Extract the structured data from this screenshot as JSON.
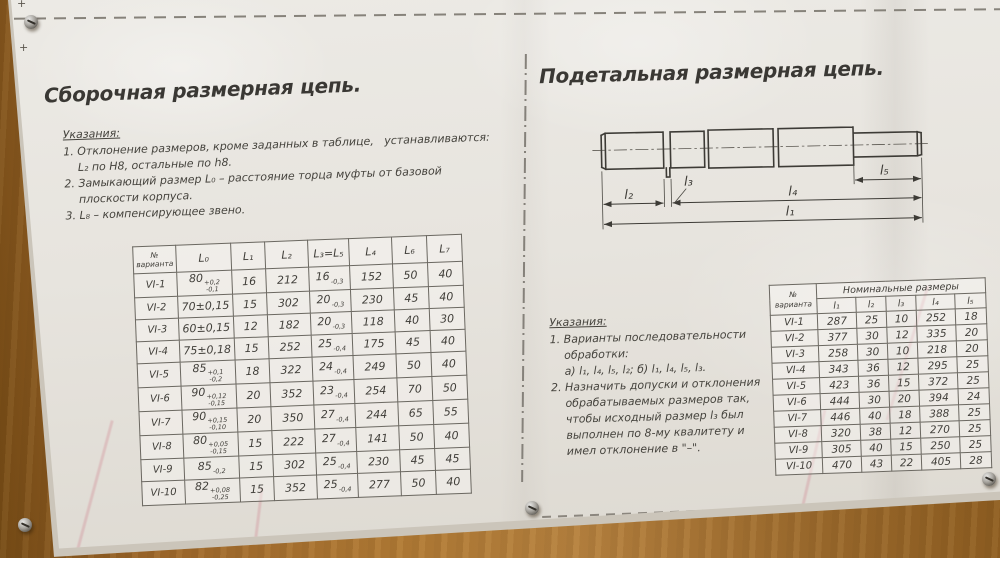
{
  "left": {
    "title": "Сборочная размерная цепь.",
    "notes_title": "Указания:",
    "notes": [
      "1. Отклонение размеров, кроме заданных в таблице,   устанавливаются:",
      "    L₂ по H8, остальные по h8.",
      "2. Замыкающий размер L₀ – расстояние торца муфты от базовой",
      "    плоскости корпуса.",
      "3. L₈ – компенсирующее звено."
    ],
    "table": {
      "headers": [
        "№ варианта",
        "L₀",
        "L₁",
        "L₂",
        "L₃=L₅",
        "L₄",
        "L₆",
        "L₇"
      ],
      "rows": [
        [
          "VI-1",
          {
            "v": "80",
            "hi": "+0,2",
            "lo": "-0,1"
          },
          "16",
          "212",
          {
            "v": "16",
            "lo": "-0,3"
          },
          "152",
          "50",
          "40"
        ],
        [
          "VI-2",
          {
            "v": "70±0,15"
          },
          "15",
          "302",
          {
            "v": "20",
            "lo": "-0,3"
          },
          "230",
          "45",
          "40"
        ],
        [
          "VI-3",
          {
            "v": "60±0,15"
          },
          "12",
          "182",
          {
            "v": "20",
            "lo": "-0,3"
          },
          "118",
          "40",
          "30"
        ],
        [
          "VI-4",
          {
            "v": "75±0,18"
          },
          "15",
          "252",
          {
            "v": "25",
            "lo": "-0,4"
          },
          "175",
          "45",
          "40"
        ],
        [
          "VI-5",
          {
            "v": "85",
            "hi": "+0,1",
            "lo": "-0,2"
          },
          "18",
          "322",
          {
            "v": "24",
            "lo": "-0,4"
          },
          "249",
          "50",
          "40"
        ],
        [
          "VI-6",
          {
            "v": "90",
            "hi": "+0,12",
            "lo": "-0,15"
          },
          "20",
          "352",
          {
            "v": "23",
            "lo": "-0,4"
          },
          "254",
          "70",
          "50"
        ],
        [
          "VI-7",
          {
            "v": "90",
            "hi": "+0,15",
            "lo": "-0,10"
          },
          "20",
          "350",
          {
            "v": "27",
            "lo": "-0,4"
          },
          "244",
          "65",
          "55"
        ],
        [
          "VI-8",
          {
            "v": "80",
            "hi": "+0,05",
            "lo": "-0,15"
          },
          "15",
          "222",
          {
            "v": "27",
            "lo": "-0,4"
          },
          "141",
          "50",
          "40"
        ],
        [
          "VI-9",
          {
            "v": "85",
            "lo": "-0,2"
          },
          "15",
          "302",
          {
            "v": "25",
            "lo": "-0,4"
          },
          "230",
          "45",
          "45"
        ],
        [
          "VI-10",
          {
            "v": "82",
            "hi": "+0,08",
            "lo": "-0,25"
          },
          "15",
          "352",
          {
            "v": "25",
            "lo": "-0,4"
          },
          "277",
          "50",
          "40"
        ]
      ]
    }
  },
  "right": {
    "title": "Подетальная размерная цепь.",
    "drawing": {
      "l1": "l₁",
      "l2": "l₂",
      "l3": "l₃",
      "l4": "l₄",
      "l5": "l₅"
    },
    "notes_title": "Указания:",
    "notes": [
      "1. Варианты последовательности",
      "    обработки:",
      "    а) l₁, l₄, l₅, l₂; б) l₁, l₄, l₅, l₃.",
      "2. Назначить допуски и отклонения",
      "    обрабатываемых размеров так,",
      "    чтобы исходный размер l₃ был",
      "    выполнен по 8-му квалитету и",
      "    имел отклонение в \"–\"."
    ],
    "table": {
      "corner_header": "№ варианта",
      "group_header": "Номинальные размеры",
      "col_headers": [
        "l₁",
        "l₂",
        "l₃",
        "l₄",
        "l₅"
      ],
      "rows": [
        [
          "VI-1",
          "287",
          "25",
          "10",
          "252",
          "18"
        ],
        [
          "VI-2",
          "377",
          "30",
          "12",
          "335",
          "20"
        ],
        [
          "VI-3",
          "258",
          "30",
          "10",
          "218",
          "20"
        ],
        [
          "VI-4",
          "343",
          "36",
          "12",
          "295",
          "25"
        ],
        [
          "VI-5",
          "423",
          "36",
          "15",
          "372",
          "25"
        ],
        [
          "VI-6",
          "444",
          "30",
          "20",
          "394",
          "24"
        ],
        [
          "VI-7",
          "446",
          "40",
          "18",
          "388",
          "25"
        ],
        [
          "VI-8",
          "320",
          "38",
          "12",
          "270",
          "25"
        ],
        [
          "VI-9",
          "305",
          "40",
          "15",
          "250",
          "25"
        ],
        [
          "VI-10",
          "470",
          "43",
          "22",
          "405",
          "28"
        ]
      ]
    }
  },
  "marks": {
    "plus_label": "+"
  }
}
